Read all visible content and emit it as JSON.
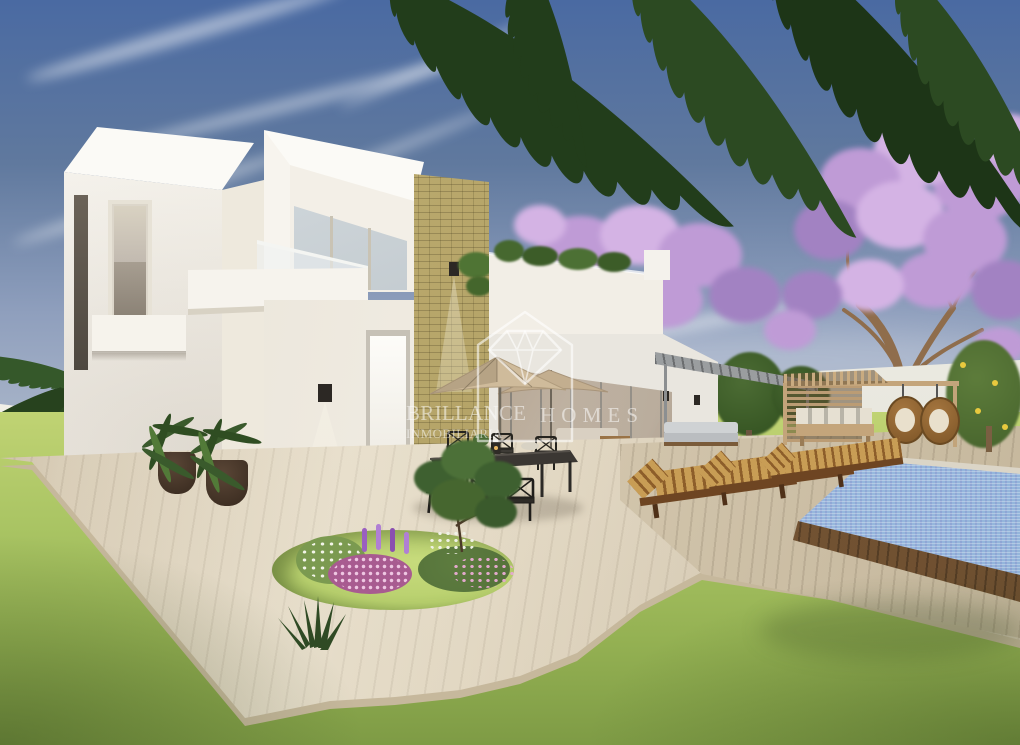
{
  "watermark": {
    "brand_word1": "BRILLANCE",
    "brand_word2": "HOMES",
    "subtitle": "INMOBILIARIA",
    "logo_icon": "house-diamond-outline",
    "color": "#ffffff"
  },
  "colors": {
    "sky_top": "#4a6aa2",
    "sky_mid": "#8f9fbd",
    "sky_horizon": "#d3d5d9",
    "cloud": "#ffffff",
    "villa_bright": "#fbfaf6",
    "villa_white": "#f5f2ea",
    "villa_shadow": "#e9e3d6",
    "stone": "#b3a266",
    "glass_cool": "#c3cdd3",
    "glass_frame": "#c9c3b4",
    "interior_warm": "#c4b29b",
    "paving": "#ddd2bc",
    "paving_edge": "#c6b89c",
    "deck": "#d2c5ac",
    "lawn": "#a9c463",
    "lawn_dark": "#7e9b45",
    "grass_ring": "#b8d06e",
    "pool_water": "#9fbfe2",
    "pool_purple": "#8b80bd",
    "pool_coping": "#dbd5c7",
    "pool_edge_wood": "#6e4f30",
    "wood_pergola": "#c4a57b",
    "lounger_wood": "#744c24",
    "cushion_stripe_a": "#c89d55",
    "cushion_stripe_b": "#8d5e2a",
    "umbrella": "#cfbb9b",
    "furniture_dark": "#35312c",
    "pot": "#4a3729",
    "palm_green": "#2d4b24",
    "leaf_green": "#4c7038",
    "jacaranda_light": "#d4b3e4",
    "jacaranda": "#bf9bd6",
    "jacaranda_deep": "#a282c2",
    "trunk": "#8f6d4c",
    "wall_pale": "#e9e8df",
    "watermark": "#ffffff"
  }
}
